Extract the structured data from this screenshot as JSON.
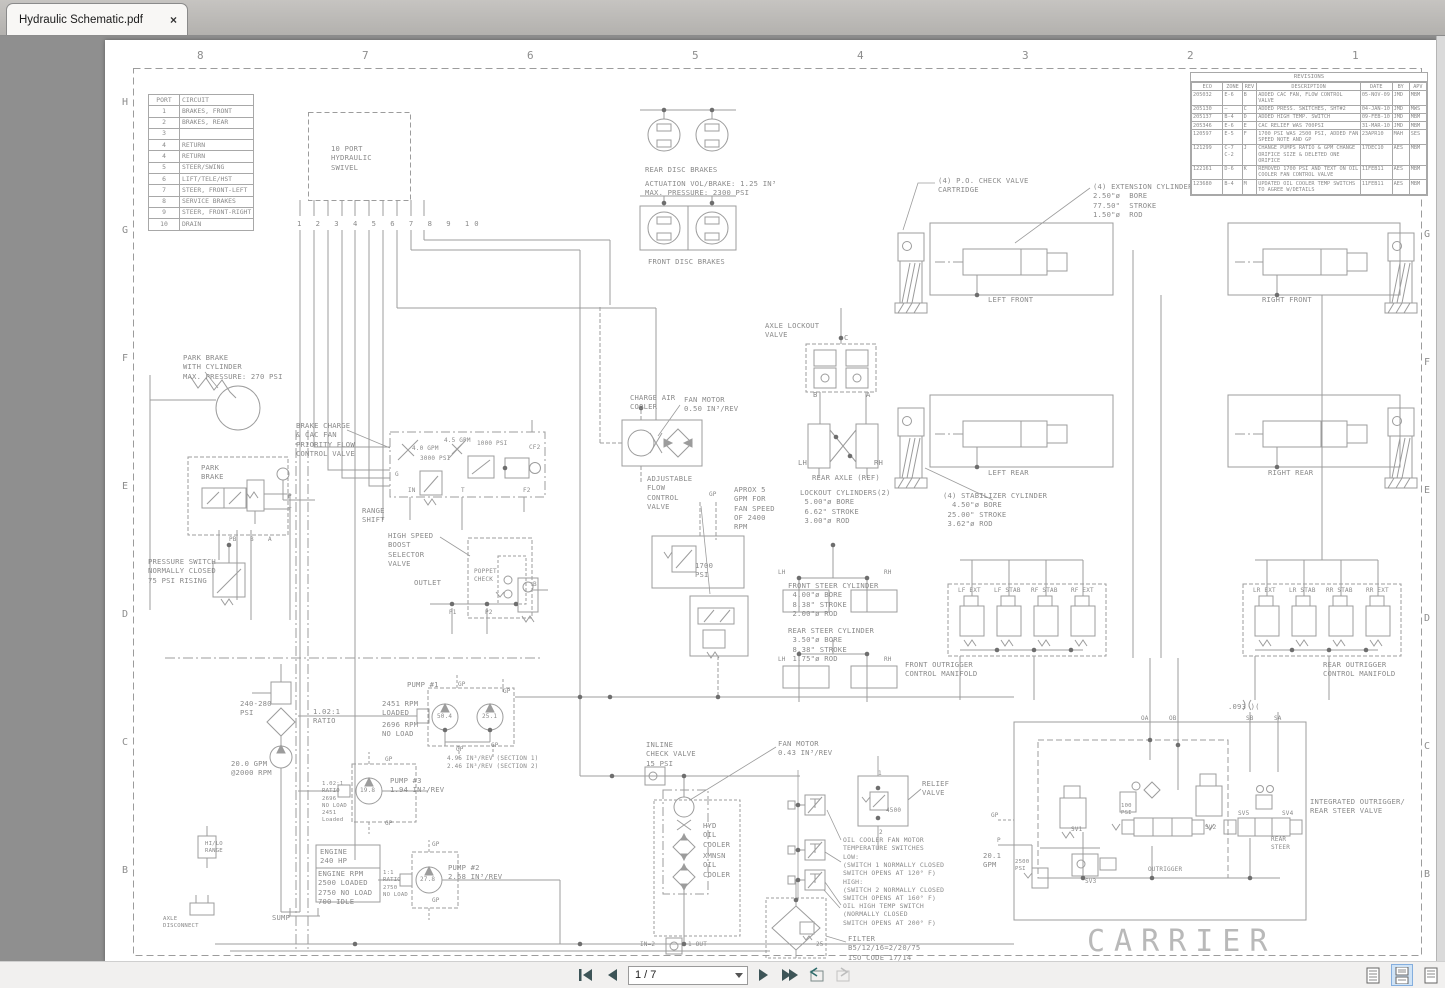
{
  "window": {
    "tab_title": "Hydraulic Schematic.pdf",
    "close_glyph": "×"
  },
  "toolbar": {
    "page_indicator": "1 / 7"
  },
  "ruler": {
    "top": [
      "8",
      "7",
      "6",
      "5",
      "4",
      "3",
      "2",
      "1"
    ],
    "left": [
      "H",
      "G",
      "F",
      "E",
      "D",
      "C",
      "B"
    ],
    "right": [
      "G",
      "F",
      "E",
      "D",
      "C",
      "B"
    ]
  },
  "port_table": {
    "headers": [
      "PORT",
      "CIRCUIT"
    ],
    "rows": [
      [
        "1",
        "BRAKES, FRONT"
      ],
      [
        "2",
        "BRAKES, REAR"
      ],
      [
        "3",
        ""
      ],
      [
        "4",
        "RETURN"
      ],
      [
        "4",
        "RETURN"
      ],
      [
        "5",
        "STEER/SWING"
      ],
      [
        "6",
        "LIFT/TELE/HST"
      ],
      [
        "7",
        "STEER, FRONT-LEFT"
      ],
      [
        "8",
        "SERVICE BRAKES"
      ],
      [
        "9",
        "STEER, FRONT-RIGHT"
      ],
      [
        "10",
        "DRAIN"
      ]
    ]
  },
  "revisions": {
    "title": "REVISIONS",
    "headers": [
      "ECO",
      "ZONE",
      "REV",
      "DESCRIPTION",
      "DATE",
      "BY",
      "APV"
    ],
    "rows": [
      [
        "205032",
        "E-6",
        "B",
        "ADDED CAC FAN, FLOW CONTROL VALVE",
        "05-NOV-09",
        "JMD",
        "MBM"
      ],
      [
        "205130",
        "—",
        "C",
        "ADDED PRESS. SWITCHES, SHT#2",
        "04-JAN-10",
        "JMD",
        "MWS"
      ],
      [
        "205137",
        "B-4",
        "D",
        "ADDED HIGH TEMP. SWITCH",
        "09-FEB-10",
        "JMD",
        "MBM"
      ],
      [
        "205346",
        "E-6",
        "E",
        "CAC RELIEF WAS 700PSI",
        "31-MAR-10",
        "JMD",
        "MBM"
      ],
      [
        "120597",
        "E-5",
        "F",
        "1700 PSI WAS 2500 PSI, ADDED FAN SPEED NOTE AND GP",
        "23APR10",
        "MAH",
        "SES"
      ],
      [
        "121299",
        "C-7 C-2",
        "J",
        "CHANGE PUMPS RATIO & GPM CHANGE ORIFICE SIZE & DELETED ONE ORIFICE",
        "17DEC10",
        "AES",
        "MBM"
      ],
      [
        "122161",
        "D-6",
        "K",
        "REMOVED 1700 PSI AND TEXT ON OIL COOLER FAN CONTROL VALVE",
        "11FEB11",
        "AES",
        "MBM"
      ],
      [
        "123680",
        "B-4",
        "M",
        "UPDATED OIL COOLER TEMP SWITCHS TO AGREE W/DETAILS",
        "11FEB11",
        "AES",
        "MBM"
      ]
    ]
  },
  "colors": {
    "line": "#9a9a9a",
    "text": "#8a8a8a",
    "accent_blue": "#cfe3f6"
  },
  "schematic": {
    "labels": [
      {
        "n": "swivel",
        "t": "10 PORT\nHYDRAULIC\nSWIVEL",
        "x": 331,
        "y": 144
      },
      {
        "n": "swivel-ports",
        "t": "1 2 3 4 5 6 7 8 9 10",
        "x": 297,
        "y": 219,
        "ls": "5px"
      },
      {
        "n": "rear-disc-brakes",
        "t": "REAR DISC BRAKES",
        "x": 645,
        "y": 165
      },
      {
        "n": "brake-specs",
        "t": "ACTUATION VOL/BRAKE: 1.25 IN³\nMAX. PRESSURE: 2300 PSI",
        "x": 645,
        "y": 179
      },
      {
        "n": "front-disc-brakes",
        "t": "FRONT DISC BRAKES",
        "x": 648,
        "y": 257
      },
      {
        "n": "po-check-valve",
        "t": "(4) P.O. CHECK VALVE\nCARTRIDGE",
        "x": 938,
        "y": 176
      },
      {
        "n": "extension-cylinders",
        "t": "(4) EXTENSION CYLINDERS\n2.50\"ø  BORE\n77.50\"  STROKE\n1.50\"ø  ROD",
        "x": 1093,
        "y": 182
      },
      {
        "n": "left-front",
        "t": "LEFT FRONT",
        "x": 988,
        "y": 295
      },
      {
        "n": "right-front",
        "t": "RIGHT FRONT",
        "x": 1262,
        "y": 295
      },
      {
        "n": "axle-lockout",
        "t": "AXLE LOCKOUT\nVALVE",
        "x": 765,
        "y": 321
      },
      {
        "n": "port-c",
        "t": "C",
        "x": 844,
        "y": 333
      },
      {
        "n": "port-b",
        "t": "B",
        "x": 813,
        "y": 390
      },
      {
        "n": "port-a",
        "t": "A",
        "x": 866,
        "y": 390
      },
      {
        "n": "lh-axle",
        "t": "LH",
        "x": 798,
        "y": 458
      },
      {
        "n": "rh-axle",
        "t": "RH",
        "x": 874,
        "y": 458
      },
      {
        "n": "rear-axle-ref",
        "t": "REAR AXLE (REF)",
        "x": 812,
        "y": 473
      },
      {
        "n": "lockout-cyls",
        "t": "LOCKOUT CYLINDERS(2)\n 5.00\"ø BORE\n 6.62\" STROKE\n 3.00\"ø ROD",
        "x": 800,
        "y": 488
      },
      {
        "n": "left-rear",
        "t": "LEFT REAR",
        "x": 988,
        "y": 468
      },
      {
        "n": "right-rear",
        "t": "RIGHT REAR",
        "x": 1268,
        "y": 468
      },
      {
        "n": "stabilizer-cyls",
        "t": "(4) STABILIZER CYLINDER\n  4.50\"ø BORE\n 25.00\" STROKE\n 3.62\"ø ROD",
        "x": 943,
        "y": 491
      },
      {
        "n": "park-brake-cyl",
        "t": "PARK BRAKE\nWITH CYLINDER\nMAX. PRESSURE: 270 PSI",
        "x": 183,
        "y": 353
      },
      {
        "n": "park-brake",
        "t": "PARK\nBRAKE",
        "x": 201,
        "y": 463
      },
      {
        "n": "range-shift",
        "t": "RANGE\nSHIFT",
        "x": 362,
        "y": 506
      },
      {
        "n": "port-pb",
        "t": "PB",
        "x": 229,
        "y": 536,
        "s": "6px"
      },
      {
        "n": "port-b2",
        "t": "B",
        "x": 250,
        "y": 536,
        "s": "6px"
      },
      {
        "n": "port-a2",
        "t": "A",
        "x": 268,
        "y": 536,
        "s": "6px"
      },
      {
        "n": "port-p",
        "t": "P",
        "x": 288,
        "y": 493,
        "s": "6px"
      },
      {
        "n": "port-t",
        "t": "T",
        "x": 288,
        "y": 507,
        "s": "6px"
      },
      {
        "n": "pressure-switch",
        "t": "PRESSURE SWITCH\nNORMALLY CLOSED\n75 PSI RISING",
        "x": 148,
        "y": 557
      },
      {
        "n": "brake-charge",
        "t": "BRAKE CHARGE\n& CAC FAN\nPRIORITY FLOW\nCONTROL VALVE",
        "x": 296,
        "y": 421
      },
      {
        "n": "gpm40",
        "t": "4.0 GPM",
        "x": 412,
        "y": 445,
        "s": "6px"
      },
      {
        "n": "gpm45",
        "t": "4.5 GPM",
        "x": 444,
        "y": 437,
        "s": "6px"
      },
      {
        "n": "psi1000",
        "t": "1000 PSI",
        "x": 477,
        "y": 440,
        "s": "6px"
      },
      {
        "n": "psi3000",
        "t": "3000 PSI",
        "x": 420,
        "y": 455,
        "s": "6px"
      },
      {
        "n": "cf2",
        "t": "CF2",
        "x": 529,
        "y": 444,
        "s": "6px"
      },
      {
        "n": "port-g",
        "t": "G",
        "x": 395,
        "y": 471,
        "s": "6px"
      },
      {
        "n": "port-in",
        "t": "IN",
        "x": 408,
        "y": 487,
        "s": "6px"
      },
      {
        "n": "port-t2",
        "t": "T",
        "x": 461,
        "y": 487,
        "s": "6px"
      },
      {
        "n": "port-f2",
        "t": "F2",
        "x": 523,
        "y": 487,
        "s": "6px"
      },
      {
        "n": "charge-air-cooler",
        "t": "CHARGE AIR\nCOOLER",
        "x": 630,
        "y": 393
      },
      {
        "n": "fan-motor-1",
        "t": "FAN MOTOR\n0.50 IN³/REV",
        "x": 684,
        "y": 395
      },
      {
        "n": "adjustable-flow",
        "t": "ADJUSTABLE\nFLOW\nCONTROL\nVALVE",
        "x": 647,
        "y": 474
      },
      {
        "n": "aprox-gpm",
        "t": "APROX 5\nGPM FOR\nFAN SPEED\nOF 2400\nRPM",
        "x": 734,
        "y": 485
      },
      {
        "n": "gp-adj",
        "t": "GP",
        "x": 709,
        "y": 491,
        "s": "6px"
      },
      {
        "n": "high-speed-boost",
        "t": "HIGH SPEED\nBOOST\nSELECTOR\nVALVE",
        "x": 388,
        "y": 531
      },
      {
        "n": "poppet-check",
        "t": "POPPET\nCHECK",
        "x": 474,
        "y": 568,
        "s": "6px"
      },
      {
        "n": "outlet",
        "t": "OUTLET",
        "x": 414,
        "y": 578
      },
      {
        "n": "port-b3",
        "t": "B",
        "x": 533,
        "y": 581,
        "s": "6px"
      },
      {
        "n": "port-p1",
        "t": "P1",
        "x": 449,
        "y": 609,
        "s": "6px"
      },
      {
        "n": "port-p2",
        "t": "P2",
        "x": 485,
        "y": 609,
        "s": "6px"
      },
      {
        "n": "psi1700",
        "t": "1700\nPSI",
        "x": 695,
        "y": 561
      },
      {
        "n": "front-steer-cyl",
        "t": "FRONT STEER CYLINDER\n 4.00\"ø BORE\n 8.38\" STROKE\n 2.00\"ø ROD",
        "x": 788,
        "y": 581
      },
      {
        "n": "rear-steer-cyl",
        "t": "REAR STEER CYLINDER\n 3.50\"ø BORE\n 8.38\" STROKE\n 1.75\"ø ROD",
        "x": 788,
        "y": 626
      },
      {
        "n": "lh-fs",
        "t": "LH",
        "x": 778,
        "y": 569,
        "s": "6px"
      },
      {
        "n": "rh-fs",
        "t": "RH",
        "x": 884,
        "y": 569,
        "s": "6px"
      },
      {
        "n": "lh-rs",
        "t": "LH",
        "x": 778,
        "y": 656,
        "s": "6px"
      },
      {
        "n": "rh-rs",
        "t": "RH",
        "x": 884,
        "y": 656,
        "s": "6px"
      },
      {
        "n": "front-outrigger-manifold",
        "t": "FRONT OUTRIGGER\nCONTROL MANIFOLD",
        "x": 905,
        "y": 660
      },
      {
        "n": "lf-ext",
        "t": "LF EXT",
        "x": 958,
        "y": 587,
        "s": "6px"
      },
      {
        "n": "lf-stab",
        "t": "LF STAB",
        "x": 994,
        "y": 587,
        "s": "6px"
      },
      {
        "n": "rf-stab",
        "t": "RF STAB",
        "x": 1031,
        "y": 587,
        "s": "6px"
      },
      {
        "n": "rf-ext",
        "t": "RF EXT",
        "x": 1071,
        "y": 587,
        "s": "6px"
      },
      {
        "n": "rear-outrigger-manifold",
        "t": "REAR OUTRIGGER\nCONTROL MANIFOLD",
        "x": 1323,
        "y": 660
      },
      {
        "n": "lr-ext",
        "t": "LR EXT",
        "x": 1253,
        "y": 587,
        "s": "6px"
      },
      {
        "n": "lr-stab",
        "t": "LR STAB",
        "x": 1289,
        "y": 587,
        "s": "6px"
      },
      {
        "n": "rr-stab",
        "t": "RR STAB",
        "x": 1326,
        "y": 587,
        "s": "6px"
      },
      {
        "n": "rr-ext",
        "t": "RR EXT",
        "x": 1366,
        "y": 587,
        "s": "6px"
      },
      {
        "n": "psi240-280",
        "t": "240-280\nPSI",
        "x": 240,
        "y": 699
      },
      {
        "n": "ratio1",
        "t": "1.02:1\nRATIO",
        "x": 313,
        "y": 707
      },
      {
        "n": "pump1",
        "t": "PUMP #1",
        "x": 407,
        "y": 680
      },
      {
        "n": "rpm2451",
        "t": "2451 RPM\nLOADED",
        "x": 382,
        "y": 699
      },
      {
        "n": "rpm2696",
        "t": "2696 RPM\nNO LOAD",
        "x": 382,
        "y": 720
      },
      {
        "n": "pump1-s1",
        "t": "50.4",
        "x": 437,
        "y": 713,
        "s": "6px"
      },
      {
        "n": "pump1-s2",
        "t": "25.1",
        "x": 482,
        "y": 713,
        "s": "6px"
      },
      {
        "n": "gp1",
        "t": "GP",
        "x": 458,
        "y": 681,
        "s": "6px"
      },
      {
        "n": "gp2",
        "t": "GP",
        "x": 503,
        "y": 688,
        "s": "6px"
      },
      {
        "n": "gp3",
        "t": "GP",
        "x": 456,
        "y": 746,
        "s": "6px"
      },
      {
        "n": "gp4",
        "t": "GP",
        "x": 491,
        "y": 742,
        "s": "6px"
      },
      {
        "n": "sections",
        "t": "4.95 IN³/REV (SECTION 1)\n2.46 IN³/REV (SECTION 2)",
        "x": 447,
        "y": 755,
        "s": "6px"
      },
      {
        "n": "gpm200",
        "t": "20.0 GPM\n@2000 RPM",
        "x": 231,
        "y": 759
      },
      {
        "n": "ratio3",
        "t": "1.02:1\nRATIO\n2696\nNO LOAD\n2451\nLoaded",
        "x": 322,
        "y": 781,
        "s": "5.6px"
      },
      {
        "n": "pump3",
        "t": "PUMP #3\n1.94 IN³/REV",
        "x": 390,
        "y": 776
      },
      {
        "n": "pump3-v",
        "t": "19.8",
        "x": 360,
        "y": 787,
        "s": "6px"
      },
      {
        "n": "gp5",
        "t": "GP",
        "x": 385,
        "y": 756,
        "s": "6px"
      },
      {
        "n": "gp6",
        "t": "GP",
        "x": 385,
        "y": 820,
        "s": "6px"
      },
      {
        "n": "engine",
        "t": "ENGINE\n240 HP",
        "x": 320,
        "y": 847
      },
      {
        "n": "engine-rpm",
        "t": "ENGINE RPM\n2500 LOADED\n2750 NO LOAD\n700 IDLE",
        "x": 318,
        "y": 869
      },
      {
        "n": "ratio11",
        "t": "1:1\nRATIO\n2750\nNO LOAD",
        "x": 383,
        "y": 870,
        "s": "5.6px"
      },
      {
        "n": "pump2",
        "t": "PUMP #2\n2.68 IN³/REV",
        "x": 448,
        "y": 863
      },
      {
        "n": "pump2-v",
        "t": "27.8",
        "x": 420,
        "y": 876,
        "s": "6px"
      },
      {
        "n": "gp7",
        "t": "GP",
        "x": 432,
        "y": 841,
        "s": "6px"
      },
      {
        "n": "gp8",
        "t": "GP",
        "x": 432,
        "y": 897,
        "s": "6px"
      },
      {
        "n": "inline-check",
        "t": "INLINE\nCHECK VALVE\n15 PSI",
        "x": 646,
        "y": 740
      },
      {
        "n": "fan-motor-2",
        "t": "FAN MOTOR\n0.43 IN³/REV",
        "x": 778,
        "y": 739
      },
      {
        "n": "hyd-oil-cooler",
        "t": "HYD\nOIL\nCOOLER",
        "x": 703,
        "y": 821
      },
      {
        "n": "xmnsn-oil-cooler",
        "t": "XMNSN\nOIL\nCOOLER",
        "x": 703,
        "y": 851
      },
      {
        "n": "relief-valve",
        "t": "RELIEF\nVALVE",
        "x": 922,
        "y": 779
      },
      {
        "n": "v4500",
        "t": "4500",
        "x": 886,
        "y": 807,
        "s": "6px"
      },
      {
        "n": "r1",
        "t": "1",
        "x": 878,
        "y": 770,
        "s": "6px"
      },
      {
        "n": "r2",
        "t": "2",
        "x": 879,
        "y": 829,
        "s": "6px"
      },
      {
        "n": "oil-cooler-switches",
        "t": "OIL COOLER FAN MOTOR\nTEMPERATURE SWITCHES\nLOW:\n(SWITCH 1 NORMALLY CLOSED\nSWITCH OPENS AT 120° F)\nHIGH:\n(SWITCH 2 NORMALLY CLOSED\nSWITCH OPENS AT 160° F)",
        "x": 843,
        "y": 836,
        "s": "6.4px"
      },
      {
        "n": "oil-high-temp",
        "t": "OIL HIGH TEMP SWITCH\n(NORMALLY CLOSED\nSWITCH OPENS AT 200° F)",
        "x": 843,
        "y": 902,
        "s": "6.4px"
      },
      {
        "n": "filter",
        "t": "FILTER\nB5/12/16=2/20/75\nISO CODE 17/14",
        "x": 848,
        "y": 934
      },
      {
        "n": "f25",
        "t": "25",
        "x": 816,
        "y": 941,
        "s": "6px"
      },
      {
        "n": "in2",
        "t": "IN=2",
        "x": 640,
        "y": 941,
        "s": "6px"
      },
      {
        "n": "out1",
        "t": "1-OUT",
        "x": 688,
        "y": 941,
        "s": "6px"
      },
      {
        "n": "sump",
        "t": "SUMP",
        "x": 272,
        "y": 913
      },
      {
        "n": "axle-disconnect",
        "t": "AXLE\nDISCONNECT",
        "x": 163,
        "y": 916,
        "s": "5.6px"
      },
      {
        "n": "hilo-range",
        "t": "HI/LO\nRANGE",
        "x": 205,
        "y": 841,
        "s": "5.6px"
      },
      {
        "n": "orifice-093",
        "t": ".093 )(",
        "x": 1228,
        "y": 702
      },
      {
        "n": "oa",
        "t": "OA",
        "x": 1141,
        "y": 715,
        "s": "6px"
      },
      {
        "n": "ob",
        "t": "OB",
        "x": 1169,
        "y": 715,
        "s": "6px"
      },
      {
        "n": "sb",
        "t": "SB",
        "x": 1246,
        "y": 715,
        "s": "6px"
      },
      {
        "n": "sa",
        "t": "SA",
        "x": 1274,
        "y": 715,
        "s": "6px"
      },
      {
        "n": "sv1",
        "t": "SV1",
        "x": 1071,
        "y": 826,
        "s": "6px"
      },
      {
        "n": "sv2",
        "t": "SV2",
        "x": 1205,
        "y": 824,
        "s": "6px"
      },
      {
        "n": "sv3",
        "t": "SV3",
        "x": 1085,
        "y": 878,
        "s": "6px"
      },
      {
        "n": "sv5",
        "t": "SV5",
        "x": 1238,
        "y": 810,
        "s": "6px"
      },
      {
        "n": "sv4",
        "t": "SV4",
        "x": 1282,
        "y": 810,
        "s": "6px"
      },
      {
        "n": "psi100",
        "t": "100\nPSI",
        "x": 1121,
        "y": 803,
        "s": "5.6px"
      },
      {
        "n": "psi2500",
        "t": "2500\nPSI",
        "x": 1015,
        "y": 859,
        "s": "5.6px"
      },
      {
        "n": "rear-steer-label",
        "t": "REAR\nSTEER",
        "x": 1271,
        "y": 836,
        "s": "6px"
      },
      {
        "n": "outrigger-label",
        "t": "OUTRIGGER",
        "x": 1148,
        "y": 866,
        "s": "6px"
      },
      {
        "n": "gpm201",
        "t": "20.1\nGPM",
        "x": 983,
        "y": 851
      },
      {
        "n": "gp-io",
        "t": "GP",
        "x": 991,
        "y": 812,
        "s": "6px"
      },
      {
        "n": "p-io",
        "t": "P",
        "x": 997,
        "y": 837,
        "s": "6px"
      },
      {
        "n": "integrated-valve",
        "t": "INTEGRATED OUTRIGGER/\nREAR STEER VALVE",
        "x": 1310,
        "y": 797
      },
      {
        "n": "carrier",
        "t": "CARRIER",
        "x": 1087,
        "y": 922,
        "cls": "carrier"
      }
    ]
  }
}
